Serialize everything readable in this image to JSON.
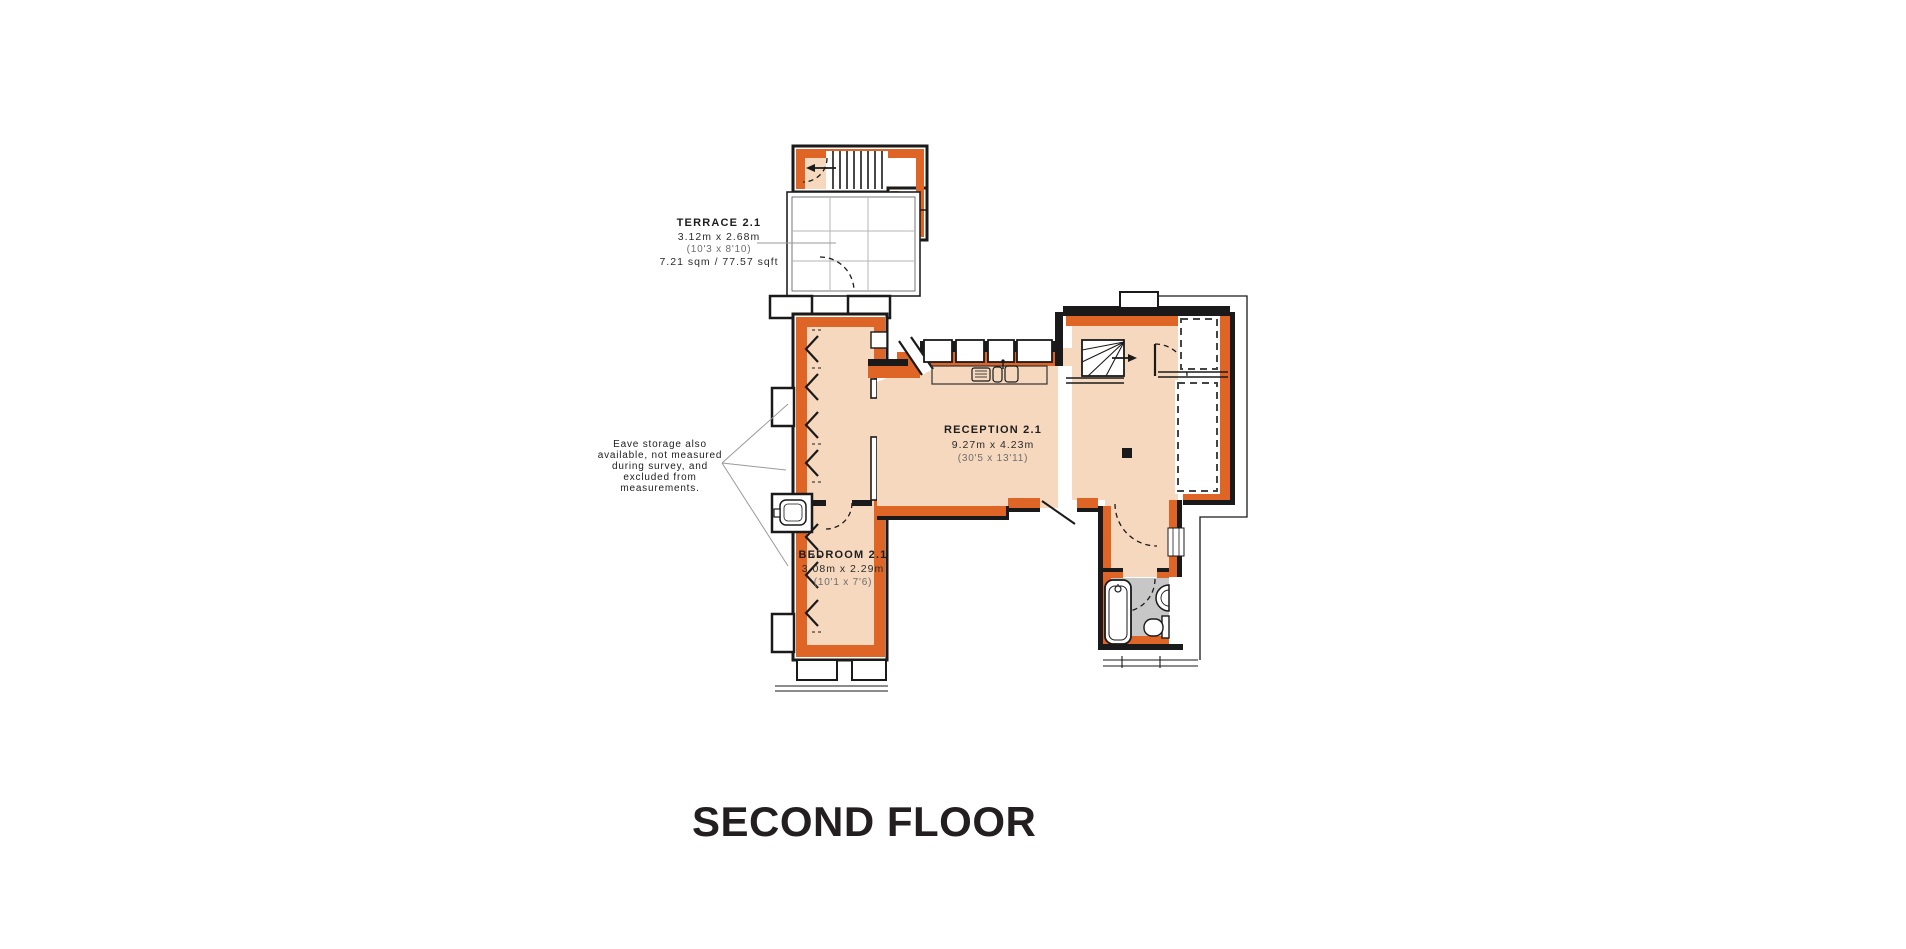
{
  "floor_title": "SECOND FLOOR",
  "rooms": {
    "terrace": {
      "name": "TERRACE 2.1",
      "metric": "3.12m x 2.68m",
      "imperial": "(10'3 x 8'10)",
      "area": "7.21 sqm / 77.57 sqft"
    },
    "reception": {
      "name": "RECEPTION 2.1",
      "metric": "9.27m x 4.23m",
      "imperial": "(30'5 x 13'11)"
    },
    "bedroom": {
      "name": "BEDROOM 2.1",
      "metric": "3.08m x 2.29m",
      "imperial": "(10'1 x 7'6)"
    }
  },
  "note": {
    "lines": [
      "Eave storage also",
      "available, not measured",
      "during survey, and",
      "excluded from",
      "measurements."
    ]
  },
  "icons": [
    "stairs-direction-arrow-icon",
    "bath-icon",
    "shower-head-icon",
    "toilet-icon",
    "washbasin-icon",
    "kitchen-sink-icon",
    "door-swing-arc",
    "eave-slope-chevron",
    "break-line-icon"
  ],
  "colors": {
    "accent_orange": "#DF6527",
    "floor_fill": "#F6D8BE",
    "wet_room_floor": "#C7C7C7",
    "wall": "#1A1A1A",
    "deck_grid": "#B5B5B5",
    "leader_line": "#9A9A9A"
  }
}
